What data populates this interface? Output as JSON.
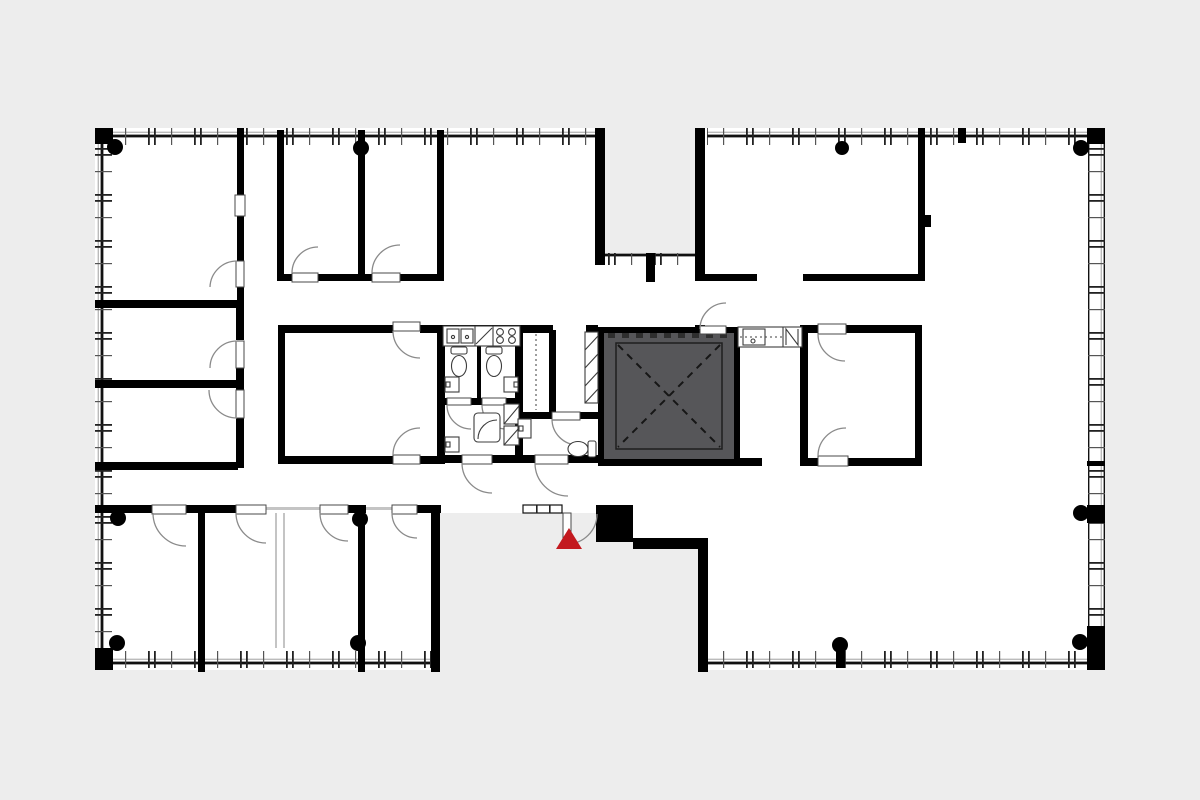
{
  "page": {
    "type": "architectural-floor-plan",
    "title": "office floor plan with central stair-elevator core and entrance marker"
  },
  "colors": {
    "background": "#ededed",
    "floor": "#ffffff",
    "wall": "#000000",
    "core_fill": "#565659",
    "core_line": "#1f1f1f",
    "partition_light": "#c4c4c4",
    "door_arc": "#8a8a8a",
    "fixture_line": "#3c3c3c",
    "window_band": "#ffffff",
    "marker_red": "#c3191f"
  },
  "marker": {
    "name": "entrance-marker",
    "glyph": "red-triangle",
    "meaning": "entry point indicator"
  },
  "core": {
    "name": "stair-elevator-core",
    "pattern": "dashed-X-diagonals",
    "fill": "dark-gray"
  },
  "symbols": [
    "window-mullion-band",
    "corner-pier",
    "column-dot",
    "door-swing-arc",
    "kitchen-counter-with-sinks",
    "stove-burners",
    "dishwasher-diagonal",
    "toilet",
    "wash-basin",
    "washer",
    "shaft-hatch",
    "closet-dashed-line",
    "kitchenette-counter",
    "zigzag-appliance"
  ]
}
